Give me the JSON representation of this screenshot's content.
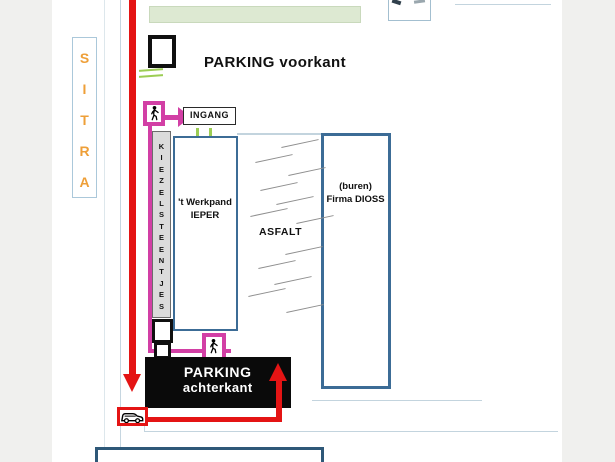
{
  "document": {
    "type": "parking-situatie-plan"
  },
  "colors": {
    "route_red": "#e41414",
    "route_magenta": "#d23fa5",
    "street_orange": "#ee9f38",
    "building_border_blue": "#3c6c96",
    "accent_green": "#9ccd54",
    "zone_green_fill": "#dde9d2"
  },
  "street": {
    "label": "S\nI\nT\nR\nA"
  },
  "front": {
    "parking_label": "PARKING voorkant"
  },
  "entrance": {
    "sign": "INGANG"
  },
  "gravel": {
    "label": "K\nI\nE\nZ\nE\nL\nS\nT\nE\nE\nN\nT\nJ\nE\nS"
  },
  "buildings": {
    "werkpand_label": "'t Werkpand\nIEPER",
    "dioss_label": "(buren)\nFirma DIOSS",
    "asfalt_label": "ASFALT"
  },
  "back": {
    "parking_line1": "PARKING",
    "parking_line2": "achterkant"
  },
  "icons": {
    "pedestrian": "walking-person",
    "car": "van-side-view"
  }
}
